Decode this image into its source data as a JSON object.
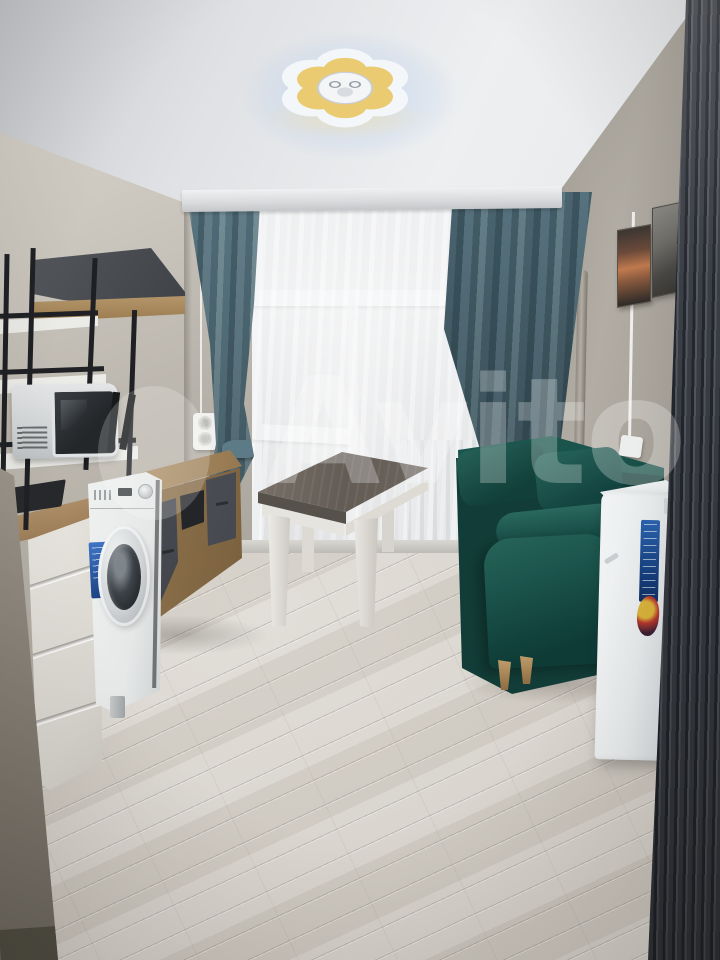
{
  "meta": {
    "kind": "photograph",
    "subject": "furnished studio apartment room (listing photo)",
    "width_px": 720,
    "height_px": 960
  },
  "watermark": {
    "text": "Avito"
  },
  "palette": {
    "wall": "#b9b4ab",
    "wallD": "#a39e94",
    "ceil": "#e4e6e8",
    "curt": "#6c8893",
    "curtD": "#4e6a76",
    "sofa": "#1a554c",
    "sofaD": "#0e3a35",
    "sofaL": "#2a685e",
    "floorA": "#d8d4cc",
    "floorB": "#c9c4bb",
    "wood": "#ab8c60",
    "woodD": "#8a6d47",
    "wardA": "#474b54",
    "wardB": "#23262c",
    "white": "#eef0f1",
    "blue": "#2a5ea8",
    "fg": "#8a8478"
  },
  "objects": {
    "ceiling_lamp": "flower-shaped LED ceiling light",
    "curtains": "teal curtains with white sheer",
    "window": "white PVC window",
    "radiator": "white radiator below window",
    "table": "table with dark top and white legs",
    "sofa": "dark teal fabric sofa",
    "fridge": "compact white fridge with blue energy label",
    "wardrobe": "dark slatted wardrobe panel",
    "washing_machine": "white front-load washing machine",
    "microwave": "microwave on black metal rack",
    "tv_stand": "wood TV stand with grey drawers",
    "cabinet": "white drawer cabinet with wood countertop",
    "wall_shelf": "wood wall shelf with dark back panel",
    "pictures": "two framed pictures on right wall",
    "floor": "light oak laminate flooring"
  }
}
